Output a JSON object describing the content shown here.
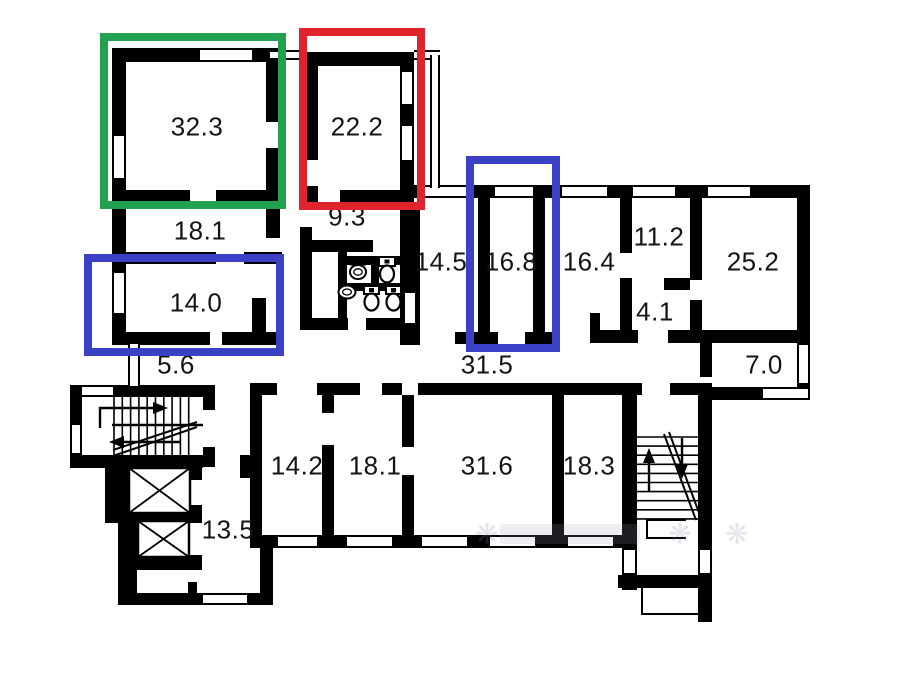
{
  "colors": {
    "wall": "#000000",
    "background": "#ffffff",
    "highlight_green": "#22a14e",
    "highlight_red": "#e0242b",
    "highlight_blue": "#3a41c6",
    "label_text": "#141414",
    "watermark": "#7e8da0"
  },
  "highlights": [
    {
      "name": "highlight-green-box",
      "color_key": "highlight_green",
      "x": 100,
      "y": 33,
      "w": 186,
      "h": 176
    },
    {
      "name": "highlight-red-box",
      "color_key": "highlight_red",
      "x": 299,
      "y": 28,
      "w": 126,
      "h": 182
    },
    {
      "name": "highlight-blue-box-room-14-0",
      "color_key": "highlight_blue",
      "x": 84,
      "y": 254,
      "w": 200,
      "h": 102
    },
    {
      "name": "highlight-blue-box-room-16-8",
      "color_key": "highlight_blue",
      "x": 466,
      "y": 156,
      "w": 94,
      "h": 196
    }
  ],
  "rooms": [
    {
      "label": "32.3",
      "x": 197,
      "y": 127
    },
    {
      "label": "22.2",
      "x": 357,
      "y": 127
    },
    {
      "label": "18.1",
      "x": 200,
      "y": 231
    },
    {
      "label": "9.3",
      "x": 347,
      "y": 217
    },
    {
      "label": "14.0",
      "x": 196,
      "y": 303
    },
    {
      "label": "5.6",
      "x": 176,
      "y": 365
    },
    {
      "label": "14.5",
      "x": 441,
      "y": 262
    },
    {
      "label": "16.8",
      "x": 511,
      "y": 262
    },
    {
      "label": "16.4",
      "x": 589,
      "y": 262
    },
    {
      "label": "11.2",
      "x": 659,
      "y": 237
    },
    {
      "label": "25.2",
      "x": 753,
      "y": 262
    },
    {
      "label": "4.1",
      "x": 655,
      "y": 312
    },
    {
      "label": "7.0",
      "x": 764,
      "y": 365
    },
    {
      "label": "31.5",
      "x": 487,
      "y": 365
    },
    {
      "label": "14.2",
      "x": 297,
      "y": 466
    },
    {
      "label": "18.1",
      "x": 375,
      "y": 466
    },
    {
      "label": "31.6",
      "x": 487,
      "y": 466
    },
    {
      "label": "18.3",
      "x": 589,
      "y": 466
    },
    {
      "label": "13.5",
      "x": 228,
      "y": 530
    }
  ],
  "watermark": {
    "glyphs": [
      "❋",
      "❋",
      "❋"
    ]
  }
}
